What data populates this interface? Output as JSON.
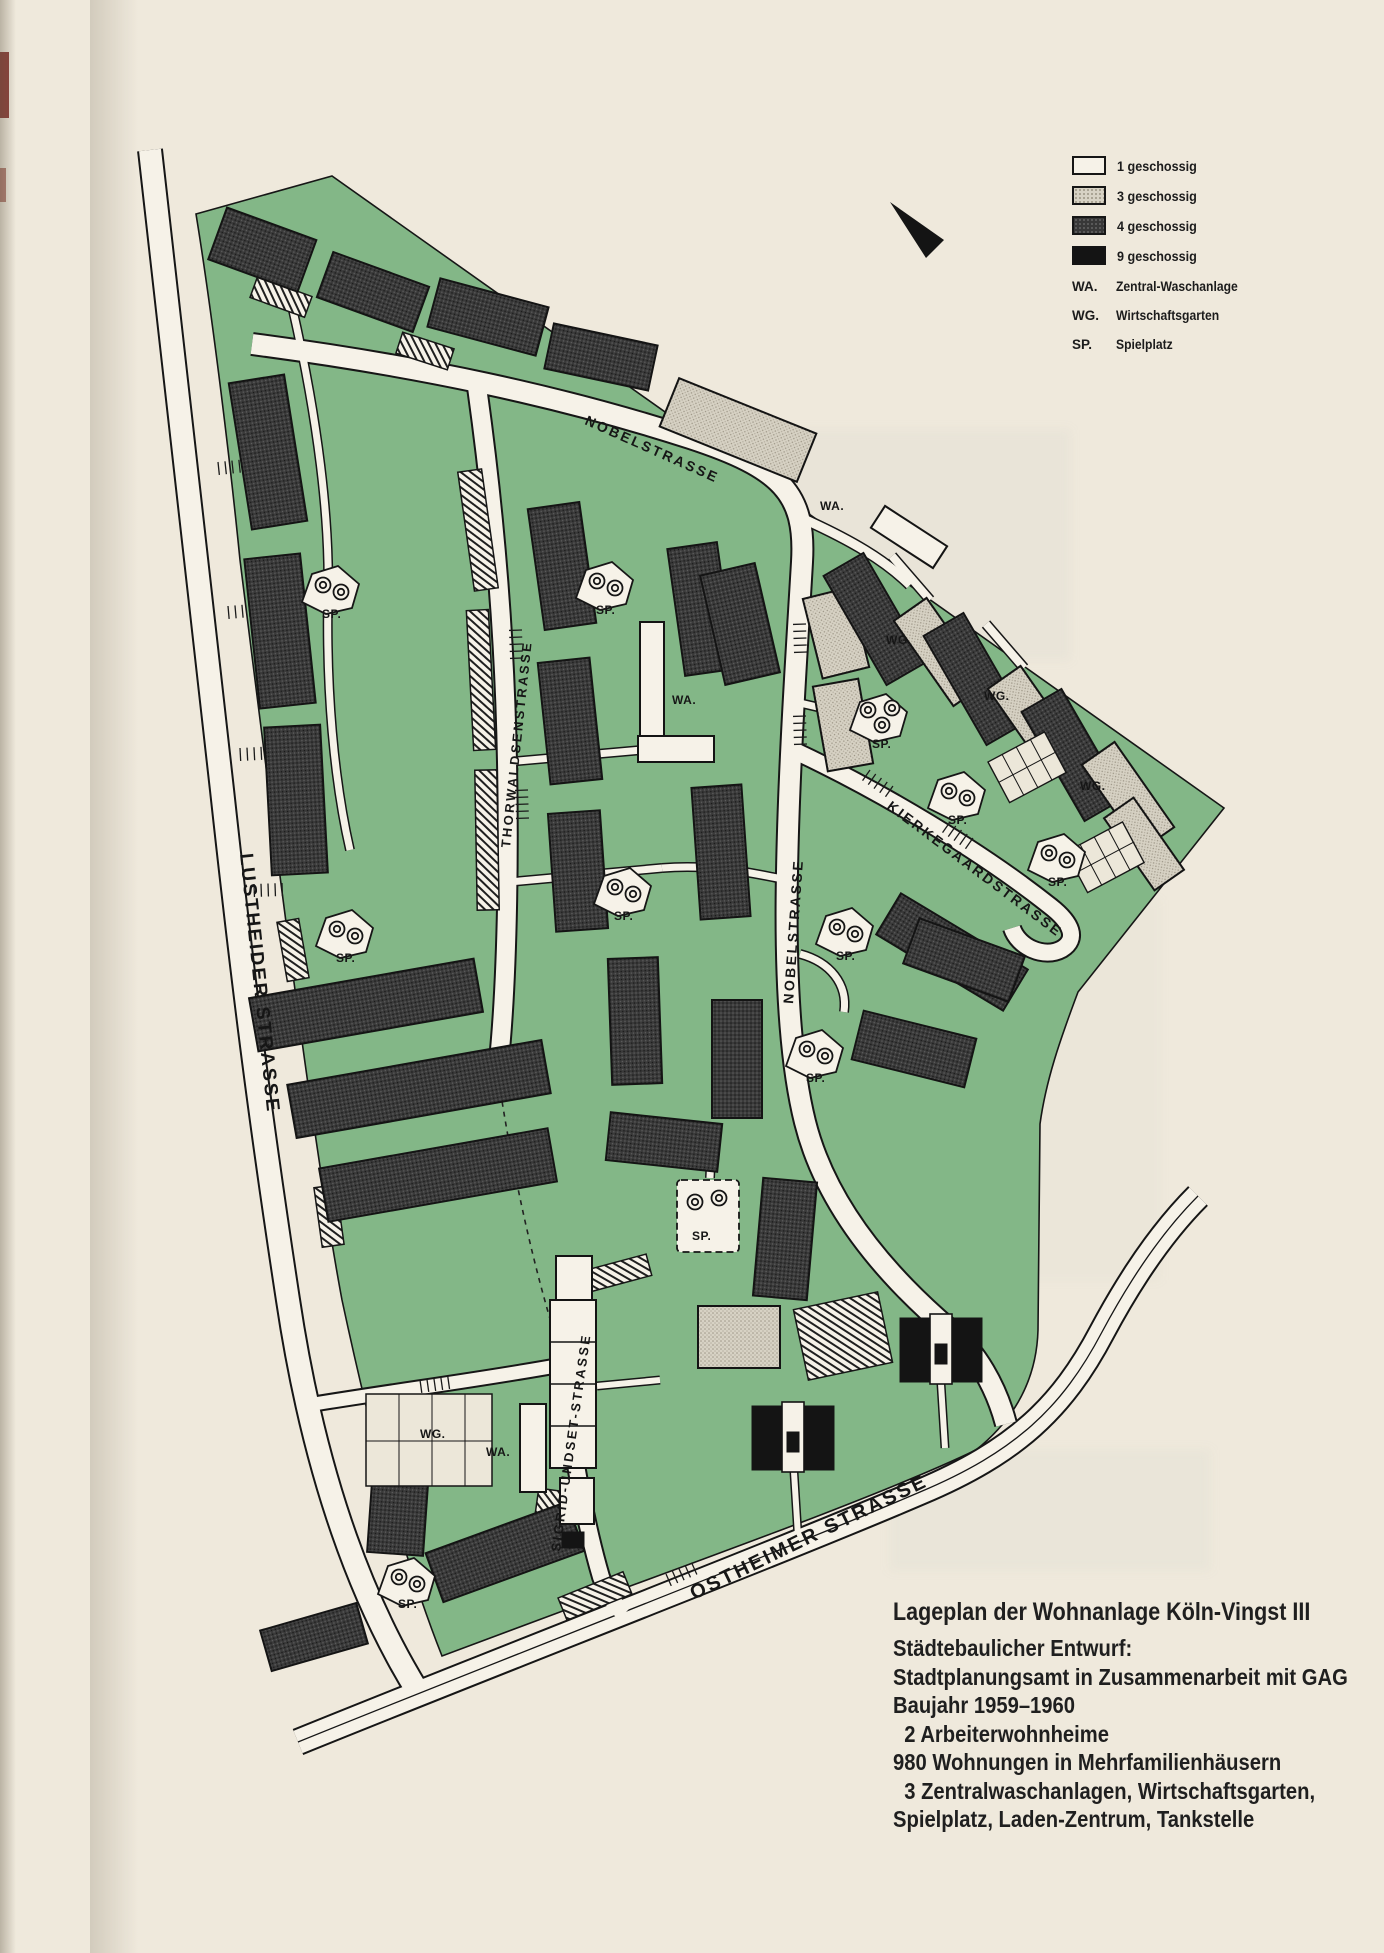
{
  "colors": {
    "paper": "#efe9dc",
    "green": "#83b787",
    "street": "#f6f2e8",
    "outline": "#161616",
    "building_4g": "#3a3a3a",
    "building_3g": "#d7d2c4",
    "building_9g": "#141414",
    "building_1g": "#f6f2e8"
  },
  "legend": {
    "items": [
      {
        "label": "1 geschossig"
      },
      {
        "label": "3 geschossig"
      },
      {
        "label": "4 geschossig"
      },
      {
        "label": "9 geschossig"
      }
    ],
    "abbr": [
      {
        "key": "WA.",
        "label": "Zentral-Waschanlage"
      },
      {
        "key": "WG.",
        "label": "Wirtschaftsgarten"
      },
      {
        "key": "SP.",
        "label": "Spielplatz"
      }
    ]
  },
  "map": {
    "streets": {
      "lustheider": "LUSTHEIDER STRASSE",
      "nobel": "NOBELSTRASSE",
      "thorwaldsen": "THORWALDSENSTRASSE",
      "kierkegaard": "KIERKEGAARDSTRASSE",
      "sigrid": "SIGRID-UNDSET-STRASSE",
      "ostheimer": "OSTHEIMER STRASSE"
    },
    "abbr": {
      "wa": "WA.",
      "wg": "WG.",
      "sp": "SP."
    }
  },
  "caption": {
    "title": "Lageplan der Wohnanlage Köln-Vingst III",
    "lines": [
      "Städtebaulicher Entwurf:",
      "Stadtplanungsamt in Zusammenarbeit mit GAG",
      "Baujahr 1959–1960",
      "  2 Arbeiterwohnheime",
      "980 Wohnungen in Mehrfamilienhäusern",
      "  3 Zentralwaschanlagen, Wirtschaftsgarten,",
      "Spielplatz, Laden-Zentrum, Tankstelle"
    ]
  }
}
